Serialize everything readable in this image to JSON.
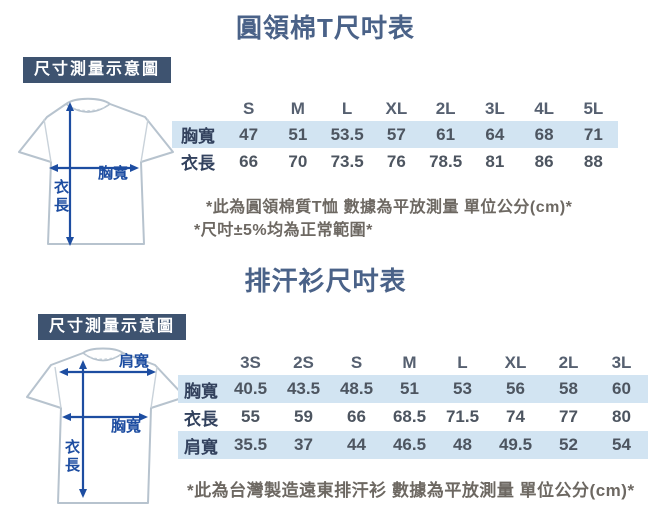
{
  "colors": {
    "title": "#4a6288",
    "badge_bg": "#3e5370",
    "badge_text": "#ffffff",
    "row_highlight": "#d2e4f2",
    "row_label": "#33425e",
    "cell_value": "#4d5560",
    "size_header": "#566070",
    "note_text": "#6d6862",
    "arrow_blue": "#1d4da1",
    "shirt_outline": "#b7c3ce"
  },
  "cotton": {
    "title": "圓領棉T尺吋表",
    "diagram": {
      "badge": "尺寸測量示意圖",
      "chest_label": "胸寬",
      "length_chars": [
        "衣",
        "長"
      ]
    },
    "sizes": [
      "S",
      "M",
      "L",
      "XL",
      "2L",
      "3L",
      "4L",
      "5L"
    ],
    "rows": [
      {
        "label": "胸寬",
        "values": [
          "47",
          "51",
          "53.5",
          "57",
          "61",
          "64",
          "68",
          "71"
        ]
      },
      {
        "label": "衣長",
        "values": [
          "66",
          "70",
          "73.5",
          "76",
          "78.5",
          "81",
          "86",
          "88"
        ]
      }
    ],
    "notes": [
      "*此為圓領棉質T恤 數據為平放測量 單位公分(cm)*",
      "*尺吋±5%均為正常範圍*"
    ]
  },
  "wicking": {
    "title": "排汗衫尺吋表",
    "diagram": {
      "badge": "尺寸測量示意圖",
      "shoulder_label": "肩寬",
      "chest_label": "胸寬",
      "length_chars": [
        "衣",
        "長"
      ]
    },
    "sizes": [
      "3S",
      "2S",
      "S",
      "M",
      "L",
      "XL",
      "2L",
      "3L"
    ],
    "rows": [
      {
        "label": "胸寬",
        "values": [
          "40.5",
          "43.5",
          "48.5",
          "51",
          "53",
          "56",
          "58",
          "60"
        ]
      },
      {
        "label": "衣長",
        "values": [
          "55",
          "59",
          "66",
          "68.5",
          "71.5",
          "74",
          "77",
          "80"
        ]
      },
      {
        "label": "肩寬",
        "values": [
          "35.5",
          "37",
          "44",
          "46.5",
          "48",
          "49.5",
          "52",
          "54"
        ]
      }
    ],
    "notes": [
      "*此為台灣製造遠東排汗衫 數據為平放測量 單位公分(cm)*"
    ]
  },
  "chart_data": [
    {
      "type": "table",
      "title": "圓領棉T尺吋表",
      "columns": [
        "S",
        "M",
        "L",
        "XL",
        "2L",
        "3L",
        "4L",
        "5L"
      ],
      "rows": [
        {
          "label": "胸寬",
          "values": [
            47,
            51,
            53.5,
            57,
            61,
            64,
            68,
            71
          ]
        },
        {
          "label": "衣長",
          "values": [
            66,
            70,
            73.5,
            76,
            78.5,
            81,
            86,
            88
          ]
        }
      ],
      "unit": "公分(cm)"
    },
    {
      "type": "table",
      "title": "排汗衫尺吋表",
      "columns": [
        "3S",
        "2S",
        "S",
        "M",
        "L",
        "XL",
        "2L",
        "3L"
      ],
      "rows": [
        {
          "label": "胸寬",
          "values": [
            40.5,
            43.5,
            48.5,
            51,
            53,
            56,
            58,
            60
          ]
        },
        {
          "label": "衣長",
          "values": [
            55,
            59,
            66,
            68.5,
            71.5,
            74,
            77,
            80
          ]
        },
        {
          "label": "肩寬",
          "values": [
            35.5,
            37,
            44,
            46.5,
            48,
            49.5,
            52,
            54
          ]
        }
      ],
      "unit": "公分(cm)"
    }
  ]
}
